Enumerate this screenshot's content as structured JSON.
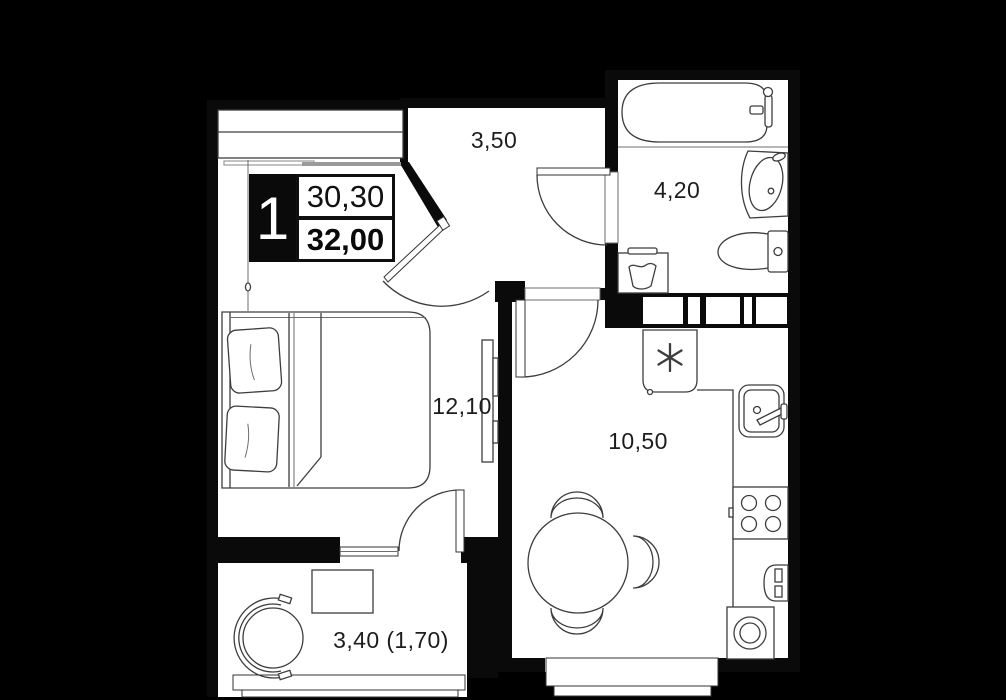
{
  "badge": {
    "number": "1",
    "living_area": "30,30",
    "total_area": "32,00"
  },
  "rooms": {
    "hallway": {
      "name": "hallway",
      "label": "3,50"
    },
    "bathroom": {
      "name": "bathroom",
      "label": "4,20"
    },
    "living_room": {
      "name": "living-room",
      "label": "12,10"
    },
    "kitchen": {
      "name": "kitchen",
      "label": "10,50"
    },
    "balcony": {
      "name": "balcony",
      "label": "3,40 (1,70)"
    }
  },
  "furniture": [
    "wardrobe",
    "double-bed",
    "tv",
    "entrance-door",
    "bathtub",
    "washbasin",
    "toilet",
    "laundry-basket",
    "refrigerator",
    "kitchen-sink",
    "stove",
    "radiator",
    "washing-machine",
    "dining-table",
    "chair",
    "armchair",
    "balcony-table",
    "window"
  ],
  "colors": {
    "background": "#000000",
    "walls": "#0a0a0a",
    "floor": "#ffffff",
    "furniture_line": "#3d3d3d",
    "text": "#1d1d1d"
  }
}
